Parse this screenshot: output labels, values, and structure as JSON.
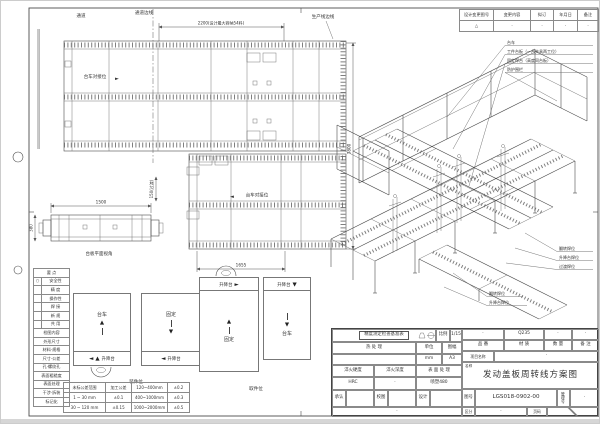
{
  "icons": {
    "arrow_right": "►",
    "arrow_left": "◄",
    "arrow_up": "▲",
    "arrow_down": "▼",
    "triangle": "△"
  },
  "revision": {
    "headers": [
      "设计变更图号",
      "变更内容",
      "拟订",
      "年月日",
      "备注"
    ],
    "row": [
      "△",
      "·",
      "·",
      "·",
      "·"
    ]
  },
  "plan_top": {
    "aisle": "通道",
    "aisle_edge": "通道边线",
    "line_edge": "生产线边线",
    "dim_width": "2200(设计最大容纳54料)",
    "dim_height": "3800",
    "dock": "台车对接位"
  },
  "plan_mid": {
    "dock": "台车对接位",
    "dim_width": "1655",
    "dim_gap": "150(过渡)"
  },
  "elevation": {
    "caption": "台板平面视角",
    "dim_length": "1500",
    "dim_height": "380"
  },
  "iso": {
    "callouts": [
      "台车",
      "工件台板（一台夹具两工位）",
      "固定焊台（高度同台板）",
      "防护围栏"
    ],
    "callouts_lower": [
      "翻转焊位",
      "升降台焊位",
      "过渡焊位"
    ],
    "callouts_side": [
      "翻转焊位",
      "升降台焊位"
    ]
  },
  "checklist": {
    "title1": "要 点",
    "mark": "○",
    "items1": [
      "安全性",
      "精 度",
      "操作性",
      "焊 接",
      "新 规",
      "共 用"
    ],
    "title2": "检图内容",
    "items2": [
      "外形尺寸",
      "材料·规格",
      "尺寸·公差",
      "孔·螺纹孔",
      "表面粗糙度",
      "表面处理",
      "干涉·拆装",
      "标记化"
    ]
  },
  "stations": {
    "load": {
      "caption": "装件位",
      "box1": "台车",
      "box2": "固定",
      "strip": "升降台"
    },
    "pick": {
      "caption": "取件位",
      "box1": "固定",
      "box2": "台车",
      "strip": "升降台"
    }
  },
  "tolerance": {
    "rows": [
      [
        "未标公差范围",
        "加工公差",
        "120~400mm",
        "±0.2"
      ],
      [
        "1 ~ 30 mm",
        "±0.1",
        "400~1000mm",
        "±0.3"
      ],
      [
        "30 ~ 120 mm",
        "±0.15",
        "1000~2000mm",
        "±0.5"
      ]
    ]
  },
  "title_block": {
    "inspection": "精度测定检查基准表",
    "scale_label": "比例",
    "scale_value": "1/15",
    "heat_label": "热 处 理",
    "unit_label": "单位",
    "sheet_label": "图幅",
    "unit_value": "mm",
    "sheet_value": "A3",
    "quench_hard_label": "淬火硬度",
    "quench_depth_label": "淬火深度",
    "surface_label": "表 面 处 理",
    "quench_hard_value": "HRC",
    "quench_depth_value": "·",
    "surface_value": "喷塑480",
    "part_values": [
      "·",
      "Q235",
      "·",
      "·"
    ],
    "part_labels": [
      "品 番",
      "材 质",
      "数 量",
      "备 注"
    ],
    "project_label": "项目名称",
    "project_value": "·",
    "name_label": "名称",
    "name_value": "发动盖板周转线方案图",
    "approve_label": "承认",
    "check_label": "校图",
    "design_label": "设计",
    "dno_label": "图号",
    "dno_value": "LGS018-0902-00",
    "mgmt_label": "管理号",
    "mgmt_value": "·",
    "class_label": "区分",
    "class_value": "·",
    "page_label": "页码",
    "footer_dot": "·"
  }
}
